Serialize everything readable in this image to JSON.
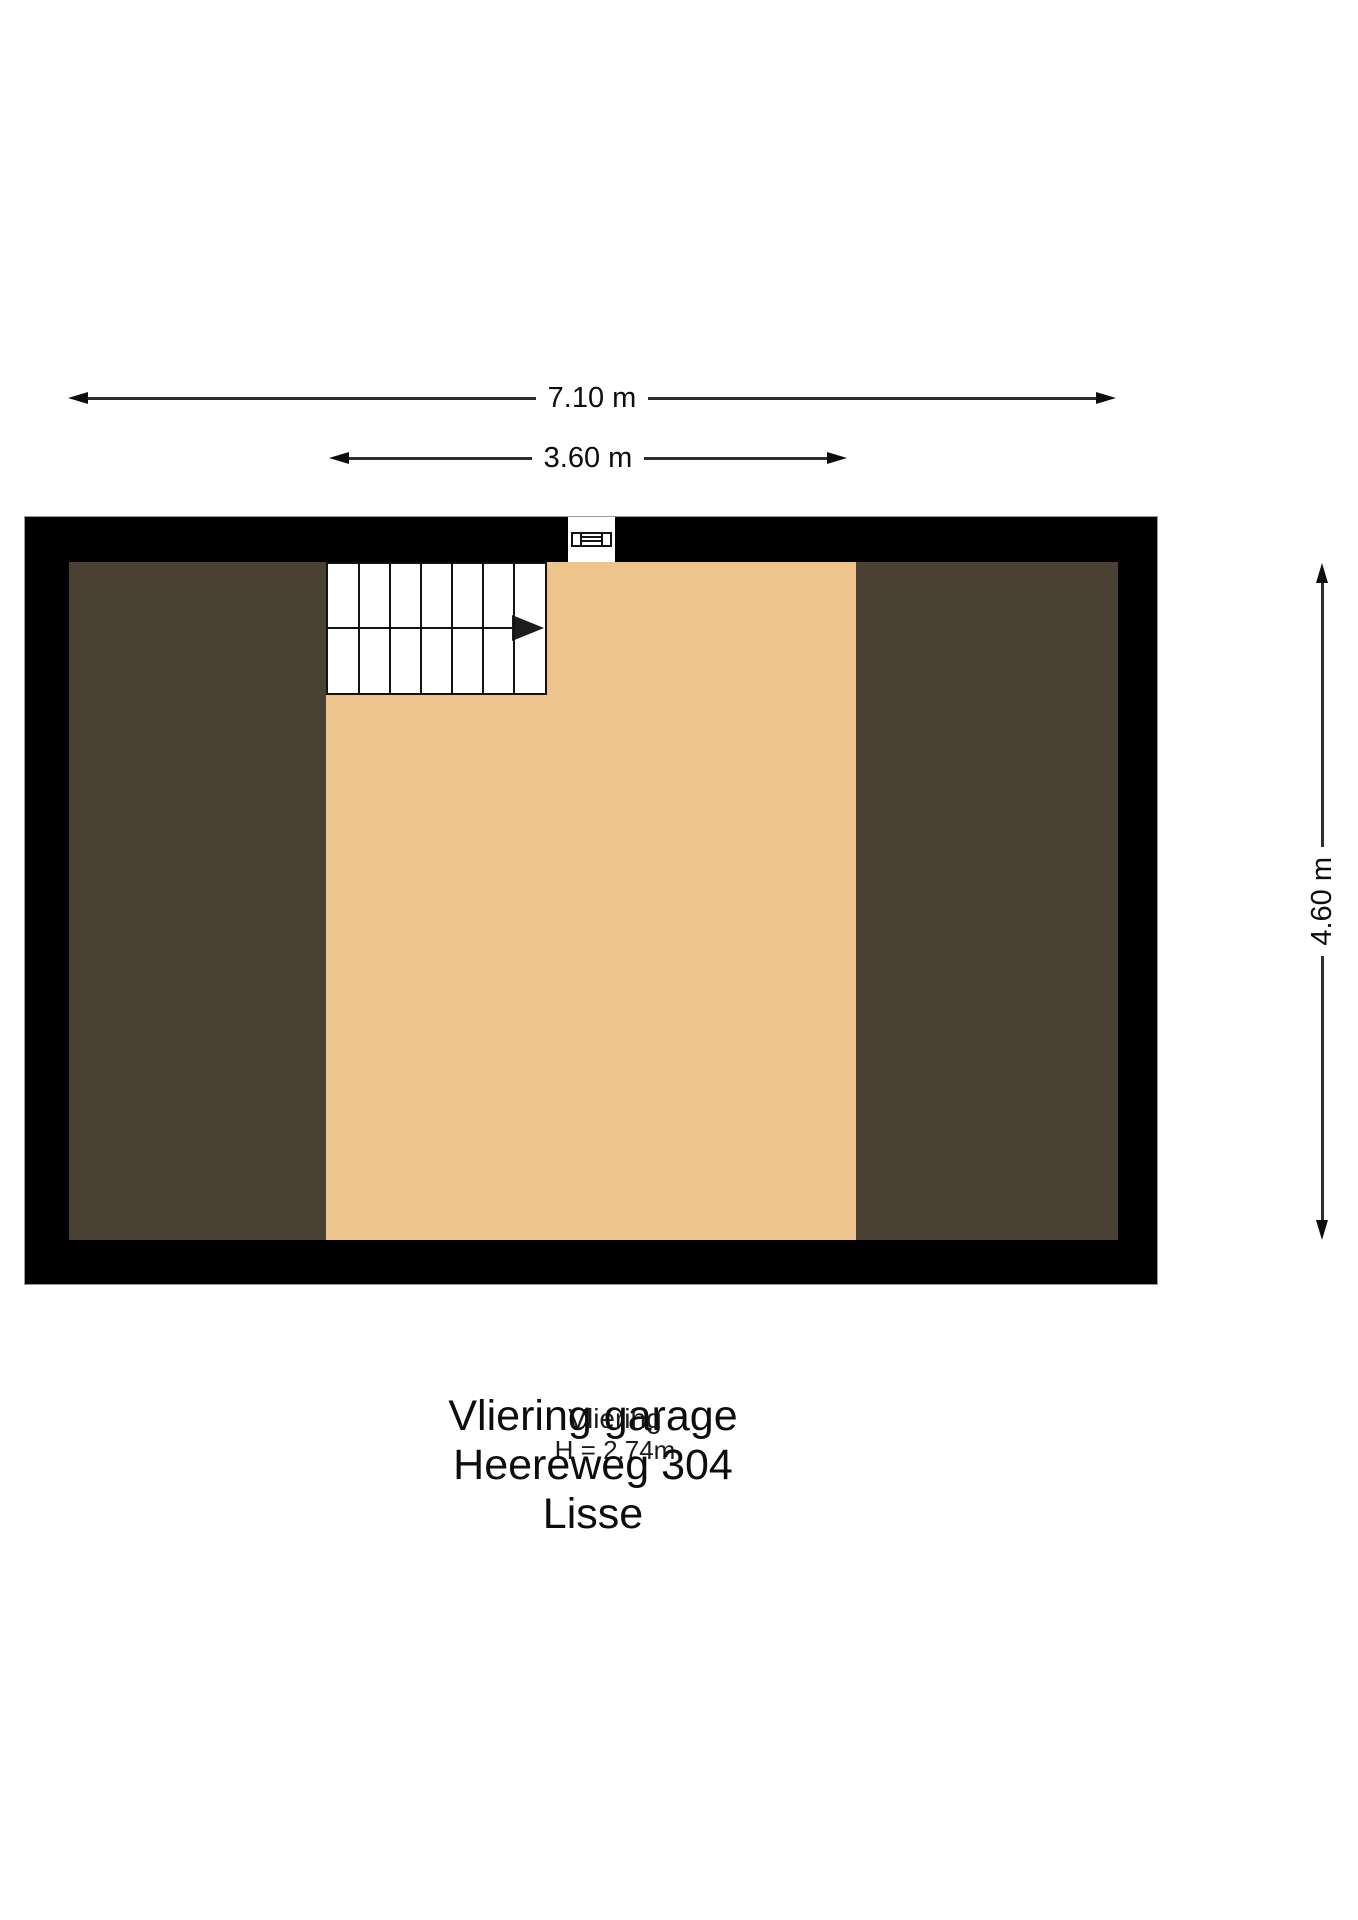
{
  "colors": {
    "wall": "#000000",
    "wall_outline": "#9a9a9a",
    "floor_center": "#ecc48c",
    "floor_side": "#4a4134",
    "dimension_line": "#2e2e2e",
    "text": "#161616"
  },
  "dimensions": {
    "total_width": "7.10 m",
    "inner_width": "3.60 m",
    "total_depth": "4.60 m"
  },
  "room": {
    "name": "Vliering",
    "ceiling_height": "H = 2.74m"
  },
  "stairs": {
    "columns": 7,
    "rows": 2
  },
  "caption": {
    "line1": "Vliering garage",
    "line2": "Heereweg 304",
    "line3": "Lisse"
  }
}
